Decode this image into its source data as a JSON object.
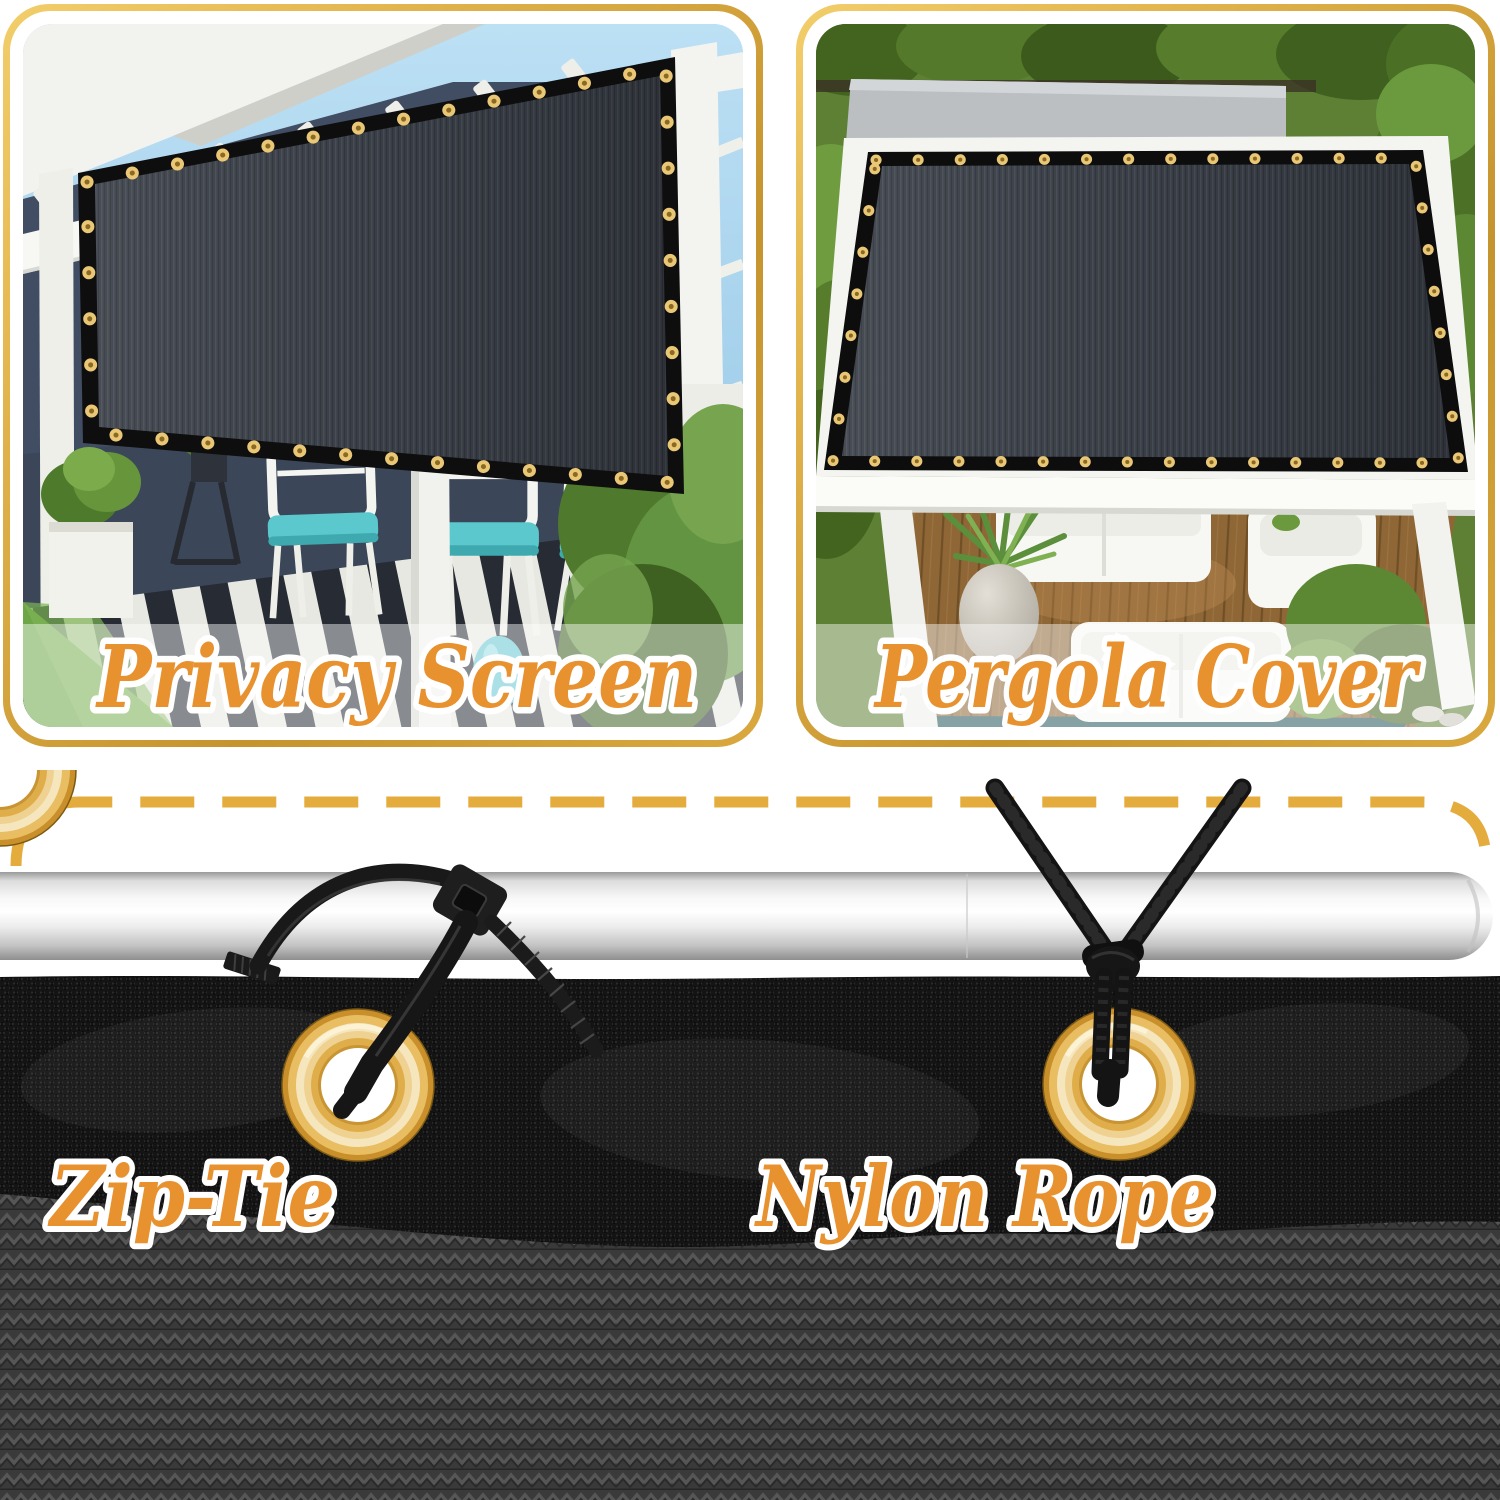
{
  "meta": {
    "type": "product-feature-collage",
    "subject": "black shade mesh / privacy screen"
  },
  "colors": {
    "background": "#FFFFFF",
    "panel_border_gold": "#D9A33C",
    "panel_border_gold_light": "#F2CE6B",
    "dashed_line_gold": "#E4AB3D",
    "label_text_orange": "#E8912F",
    "label_outline_white": "#FFFFFF",
    "caption_band_overlay": "rgba(255,255,255,0.45)",
    "grommet_brass": "#DDA032",
    "screen_fabric_dark": "#3A3F47",
    "mesh_black": "#151515",
    "weave_gray": "#3A3A3A",
    "pole_silver": "#EDEDED",
    "zip_tie_black": "#161616",
    "rope_black": "#141414",
    "cushion_teal": "#59C7CE",
    "deck_wood_brown": "#936A38",
    "grass_green": "#6CA647",
    "sky_blue": "#A7CFEA",
    "wall_navy": "#414D63"
  },
  "panels": [
    {
      "id": "privacy-screen",
      "label": "Privacy Screen"
    },
    {
      "id": "pergola-cover",
      "label": "Pergola Cover"
    }
  ],
  "attachments": [
    {
      "id": "zip-tie",
      "label": "Zip-Tie"
    },
    {
      "id": "nylon-rope",
      "label": "Nylon Rope"
    }
  ]
}
